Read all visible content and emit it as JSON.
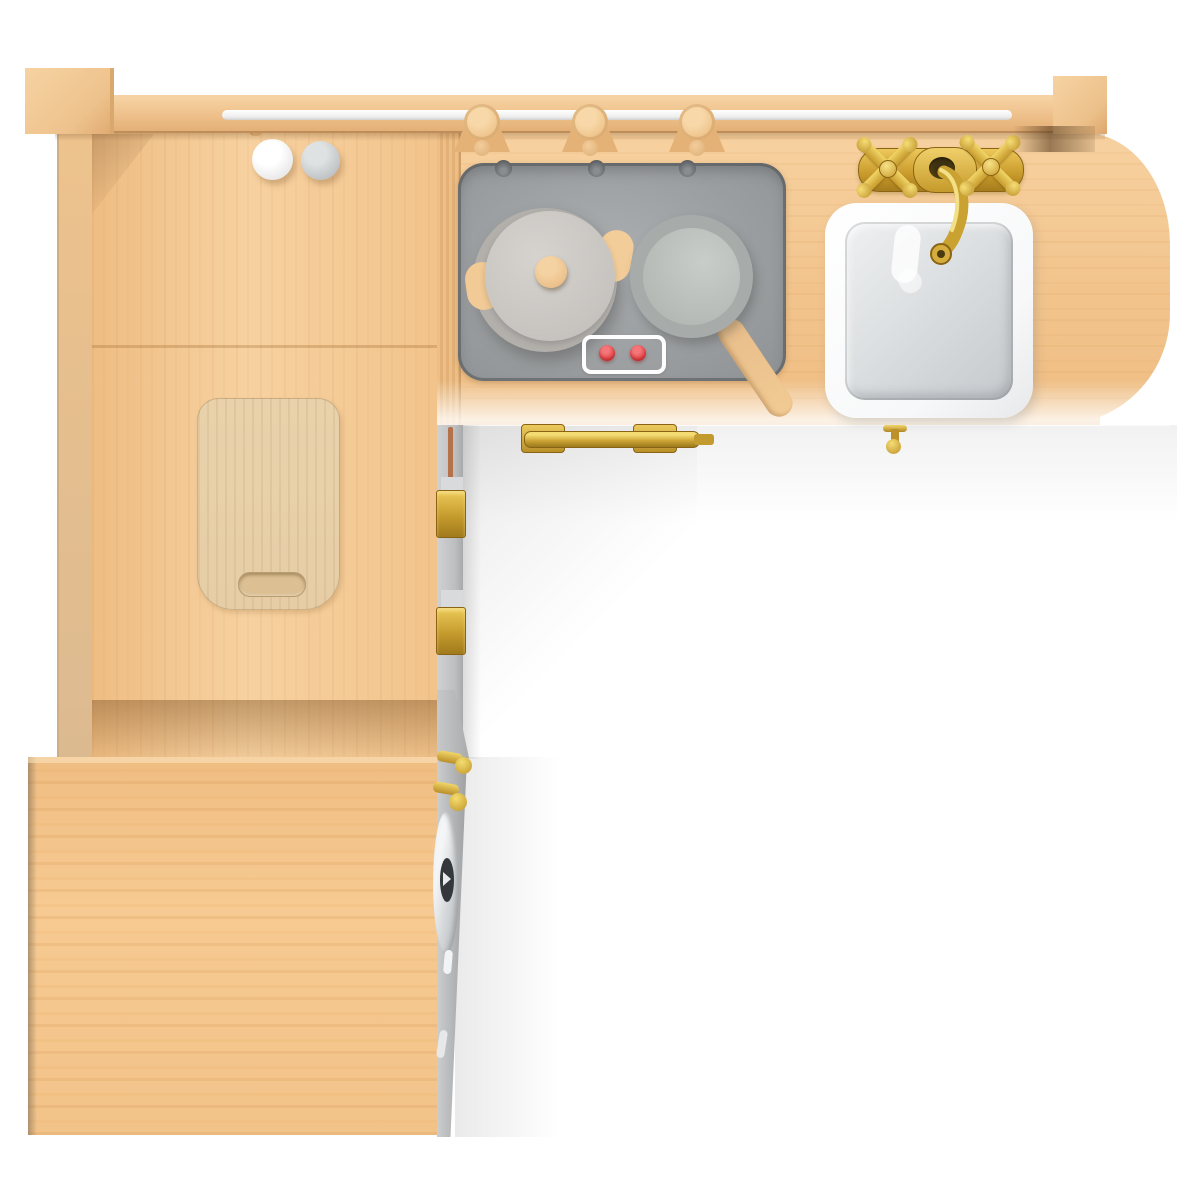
{
  "scene": {
    "type": "3d-product-render",
    "subject": "Wooden toy play kitchen, L-shaped unit, top-down view",
    "background_color": "#ffffff"
  },
  "colors": {
    "wood_base": "#f2c48c",
    "wood_light": "#f7d1a0",
    "wood_mid": "#eebd83",
    "wood_dark": "#dcb187",
    "wood_shadow": "#c59a66",
    "board": "#e6cda6",
    "stove_gray": "#9b9ea0",
    "stove_dark": "#5c5f62",
    "pot_lid": "#cbc8c4",
    "pot_rim": "#b3b0ac",
    "pan_rim": "#a7acaa",
    "pan_inner": "#b9bdba",
    "knob_wood": "#ecc18c",
    "red": "#e23e42",
    "sink_rim": "#f7f8f9",
    "basin_light": "#eef0f1",
    "basin_dark": "#c5c9cc",
    "brass": "#d0a62f",
    "brass_light": "#f2d669",
    "brass_dark": "#8a6414",
    "strip_gray": "#bcbec0",
    "chrome": "#e9ebec",
    "copper": "#b5714a",
    "bg": "#ffffff"
  },
  "objects": [
    {
      "name": "back-rail",
      "desc": "wooden back rail with white metal hanging rod"
    },
    {
      "name": "utensil-hooks",
      "desc": "wooden hooks on the hanging rod",
      "count": 3
    },
    {
      "name": "hanging-balls",
      "desc": "one white and one gray ball below the rod",
      "count": 2
    },
    {
      "name": "side-panel",
      "desc": "left side wall with long vertical handle slot"
    },
    {
      "name": "cutting-board",
      "desc": "light wooden cutting board with handle slot"
    },
    {
      "name": "stove-panel",
      "desc": "gray stove top with three dark screws",
      "screw_count": 3
    },
    {
      "name": "pot",
      "desc": "gray lidded pot with wooden knob and two wooden side handles"
    },
    {
      "name": "frying-pan",
      "desc": "gray frying pan with wooden handle pointing lower right"
    },
    {
      "name": "control-panel",
      "desc": "white outlined plate with two red knobs",
      "knob_count": 2
    },
    {
      "name": "sink",
      "desc": "white square sink with rounded corners"
    },
    {
      "name": "faucet",
      "desc": "brass faucet plate with two cross handles and curved spout",
      "handle_count": 2
    },
    {
      "name": "drain-tap",
      "desc": "small brass fitting below the sink"
    },
    {
      "name": "door-handle",
      "desc": "brass bar handle under the stove counter"
    },
    {
      "name": "hinges",
      "desc": "brass hinges on the corner cabinet edge",
      "count": 2
    },
    {
      "name": "latch",
      "desc": "chrome latch on the lower bench edge with gold pegs"
    },
    {
      "name": "bench-box",
      "desc": "lower wooden storage bench seat"
    }
  ]
}
